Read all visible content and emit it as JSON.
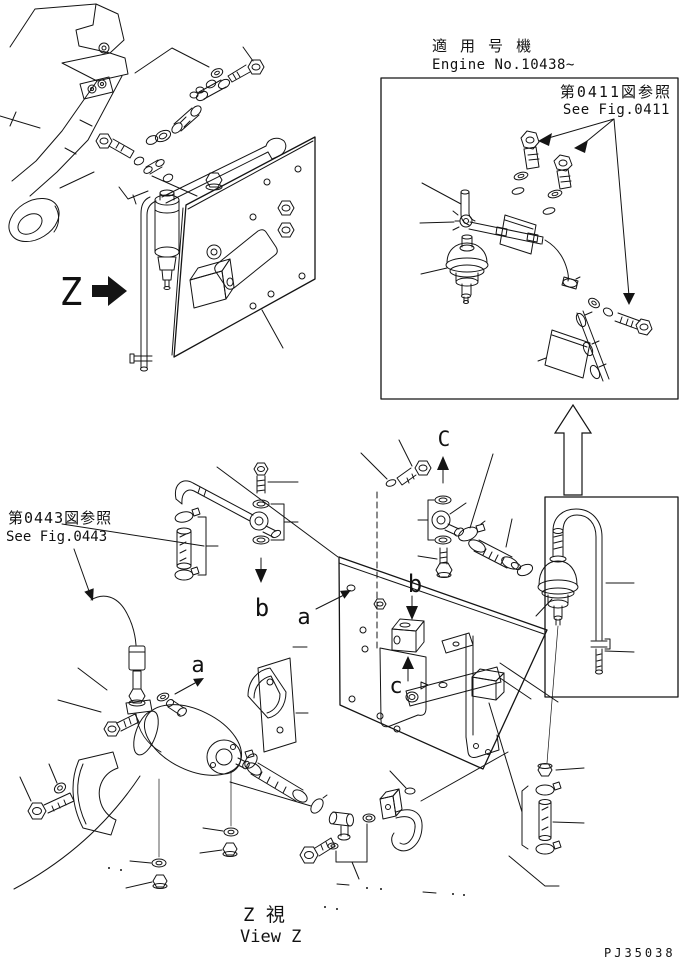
{
  "palette": {
    "background": "#ffffff",
    "ink": "#141414"
  },
  "header": {
    "applicable_model_jp": "適 用 号 機",
    "applicable_model_en": "Engine No.10438~"
  },
  "references": {
    "fig0411_jp": "第0411図参照",
    "fig0411_en": "See Fig.0411",
    "fig0443_jp": "第0443図参照",
    "fig0443_en": "See Fig.0443"
  },
  "view_markers": {
    "z_pointer": "Z",
    "view_c": "C",
    "point_b_source": "b",
    "point_b_target": "b",
    "point_a_source": "a",
    "point_a_target": "a",
    "point_c_target": "c"
  },
  "footer": {
    "view_caption_jp": "Z 視",
    "view_caption_en": "View Z",
    "drawing_code": "PJ35038"
  }
}
